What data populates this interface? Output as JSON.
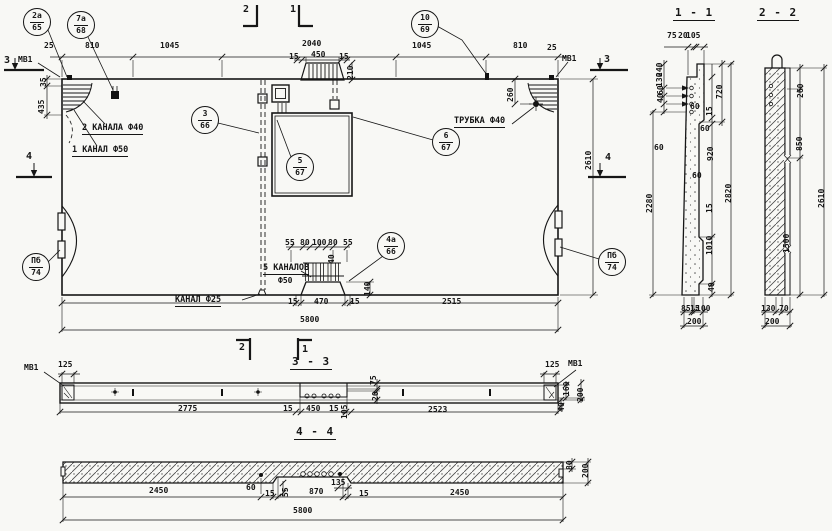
{
  "callouts": {
    "c2a": {
      "top": "2а",
      "bottom": "65"
    },
    "c7a": {
      "top": "7а",
      "bottom": "68"
    },
    "c10": {
      "top": "10",
      "bottom": "69"
    },
    "c3": {
      "top": "3",
      "bottom": "66"
    },
    "c5": {
      "top": "5",
      "bottom": "67"
    },
    "c6": {
      "top": "6",
      "bottom": "67"
    },
    "c4a": {
      "top": "4а",
      "bottom": "66"
    },
    "cpb_left": {
      "top": "Пб",
      "bottom": "74"
    },
    "cpb_right": {
      "top": "Пб",
      "bottom": "74"
    }
  },
  "titles": {
    "s11": "1 - 1",
    "s22": "2 - 2",
    "s33": "3 - 3",
    "s44": "4 - 4"
  },
  "marks": {
    "m1": "1",
    "m2": "2",
    "m3": "3",
    "m4": "4"
  },
  "labels": {
    "mv1": "МВ1",
    "two_channels": "2 КАНАЛА Ф40",
    "one_channel": "1 КАНАЛ Ф50",
    "tube": "ТРУБКА Ф40",
    "five_channels": "5 КАНАЛОВ",
    "five_channels_dia": "Ф50",
    "channel25": "КАНАЛ Ф25"
  },
  "dims": {
    "plan_top": [
      "25",
      "810",
      "1045",
      "2040",
      "1045",
      "810",
      "25"
    ],
    "plan_recess": [
      "15",
      "450",
      "15",
      "210"
    ],
    "plan_left": [
      "35",
      "435"
    ],
    "plan_right": [
      "260",
      "2610"
    ],
    "plan_channels": [
      "55",
      "80",
      "100",
      "80",
      "55",
      "40",
      "140"
    ],
    "plan_bottom": [
      "15",
      "470",
      "15",
      "2515",
      "5800"
    ],
    "s11_top": [
      "75",
      "20",
      "105"
    ],
    "s11_left": [
      "240",
      "130",
      "60",
      "40",
      "60",
      "2280"
    ],
    "s11_right": [
      "720",
      "15",
      "60",
      "920",
      "60",
      "15",
      "1010",
      "40",
      "2820",
      "60"
    ],
    "s11_bottom": [
      "85",
      "15",
      "100",
      "200"
    ],
    "s22_right": [
      "260",
      "850",
      "1500",
      "2610"
    ],
    "s22_bottom": [
      "130",
      "70",
      "200"
    ],
    "s33_top": [
      "125",
      "125"
    ],
    "s33_recess": [
      "75",
      "20",
      "105"
    ],
    "s33_bottom": [
      "2775",
      "15",
      "450",
      "15",
      "2523"
    ],
    "s33_right": [
      "160",
      "200",
      "40"
    ],
    "s44_bottom": [
      "2450",
      "60",
      "15",
      "55",
      "870",
      "135",
      "15",
      "2450",
      "5800"
    ],
    "s44_right": [
      "80",
      "200"
    ]
  }
}
